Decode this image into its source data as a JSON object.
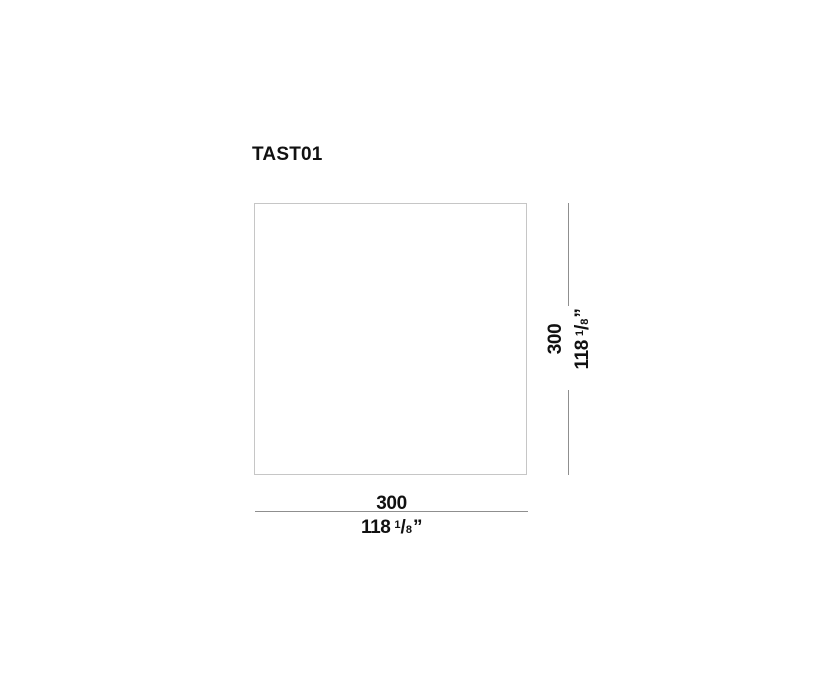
{
  "colors": {
    "background": "#ffffff",
    "outline_border": "#c6c6c6",
    "dimension_line": "#8f8f8f",
    "text": "#111111"
  },
  "drawing": {
    "title": "TAST01",
    "shape": "square-outline",
    "height_dimension": {
      "cm": "300",
      "inches_whole": "118",
      "frac_numerator": "1",
      "frac_slash": "/",
      "frac_denominator": "8",
      "unit_mark": "”"
    },
    "width_dimension": {
      "cm": "300",
      "inches_whole": "118",
      "frac_numerator": "1",
      "frac_slash": "/",
      "frac_denominator": "8",
      "unit_mark": "”"
    }
  }
}
